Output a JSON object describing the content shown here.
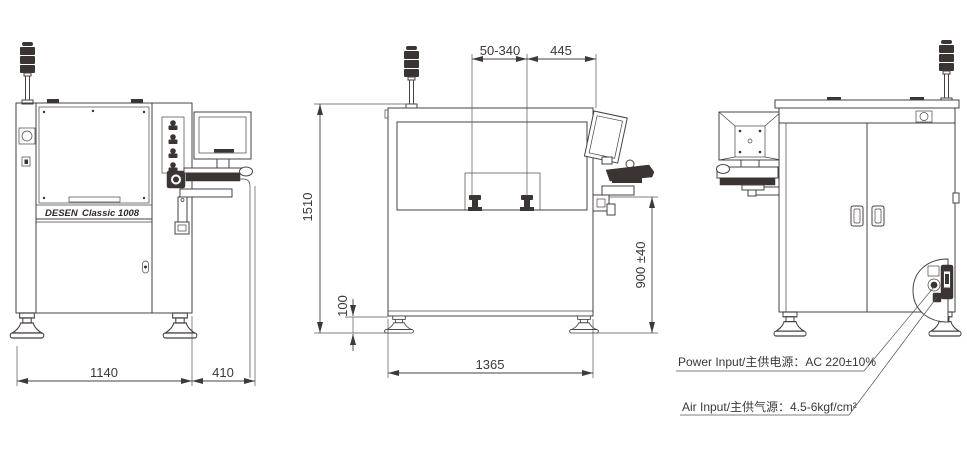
{
  "drawing_title": "Stencil printer dimensional drawing (front / side / rear views)",
  "brand": {
    "name": "DESEN",
    "model": "Classic 1008"
  },
  "dimensions": {
    "front_width": "1140",
    "arm_depth": "410",
    "rail_travel": "50-340",
    "monitor_offset": "445",
    "total_height": "1510",
    "base_height": "100",
    "work_height": "900 ±40",
    "side_width": "1365"
  },
  "callouts": {
    "power": "Power Input/主供电源：AC 220±10%",
    "air": "Air Input/主供气源：4.5-6kgf/cm²"
  },
  "colors": {
    "line": "#474140",
    "dark_fill": "#3a3433",
    "text": "#3c3837",
    "background": "#ffffff"
  }
}
